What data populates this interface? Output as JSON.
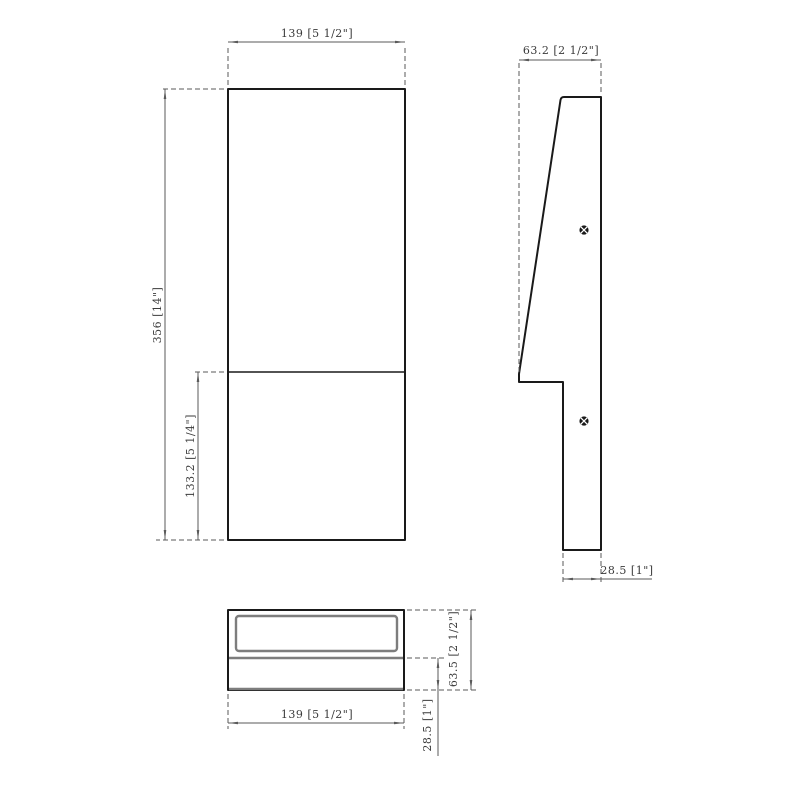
{
  "document": {
    "kind": "technical-drawing",
    "description": "Three-view dimensioned CAD drawing of a wedge-shaped wall fixture"
  },
  "colors": {
    "background": "#ffffff",
    "object_line": "#1a1a1a",
    "secondary_line": "#7d7d7d",
    "dim_line": "#5a5a5a",
    "text_color": "#3a3a3a"
  },
  "views": {
    "front": {
      "label": "front-view",
      "dims": {
        "width": "139 [5 1/2\"]",
        "height": "356 [14\"]",
        "lower_height": "133.2 [5 1/4\"]"
      }
    },
    "side": {
      "label": "side-view",
      "screw_count": 2,
      "dims": {
        "depth": "63.2 [2 1/2\"]",
        "base_depth": "28.5 [1\"]"
      }
    },
    "bottom": {
      "label": "bottom-view",
      "dims": {
        "width": "139 [5 1/2\"]",
        "depth": "63.5 [2 1/2\"]",
        "base_depth": "28.5 [1\"]"
      }
    }
  }
}
